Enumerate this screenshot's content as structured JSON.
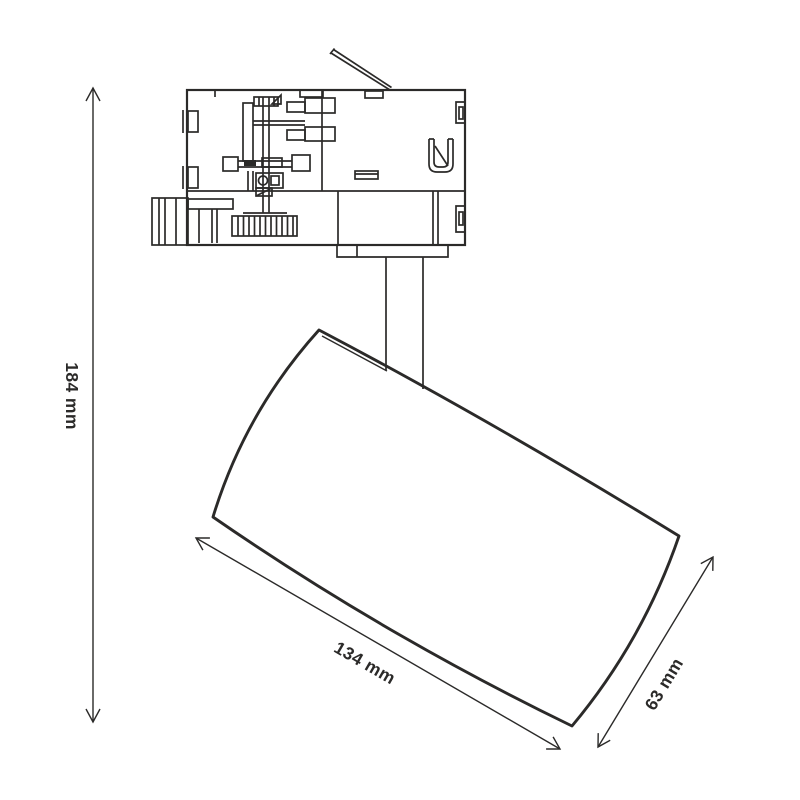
{
  "dimensions": {
    "height": {
      "label": "184 mm",
      "value": 184,
      "unit": "mm"
    },
    "length": {
      "label": "134 mm",
      "value": 134,
      "unit": "mm"
    },
    "width": {
      "label": "63 mm",
      "value": 63,
      "unit": "mm"
    }
  },
  "colors": {
    "line": "#2b2a29",
    "background": "#ffffff"
  }
}
